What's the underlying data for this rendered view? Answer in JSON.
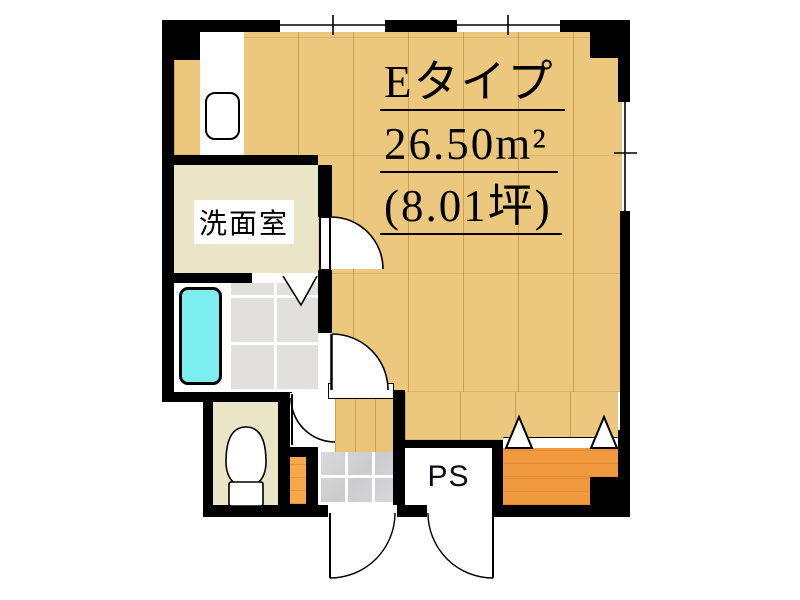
{
  "floor_plan": {
    "title": {
      "line1": "Eタイプ",
      "line2": "26.50m²",
      "line3": "(8.01坪)"
    },
    "labels": {
      "washroom": "洗面室",
      "pipe_space": "PS"
    },
    "colors": {
      "wall": "#000000",
      "wood_floor": "#ecc87e",
      "hall_floor": "#eac478",
      "washroom_floor": "#e9e6c8",
      "bath_tile": "#e2e0dc",
      "entrance_tile": "#d3d3d7",
      "bathtub": "#7deef0",
      "closet": "#f0993e",
      "cabinet": "#f6a84c",
      "background": "#ffffff"
    }
  }
}
